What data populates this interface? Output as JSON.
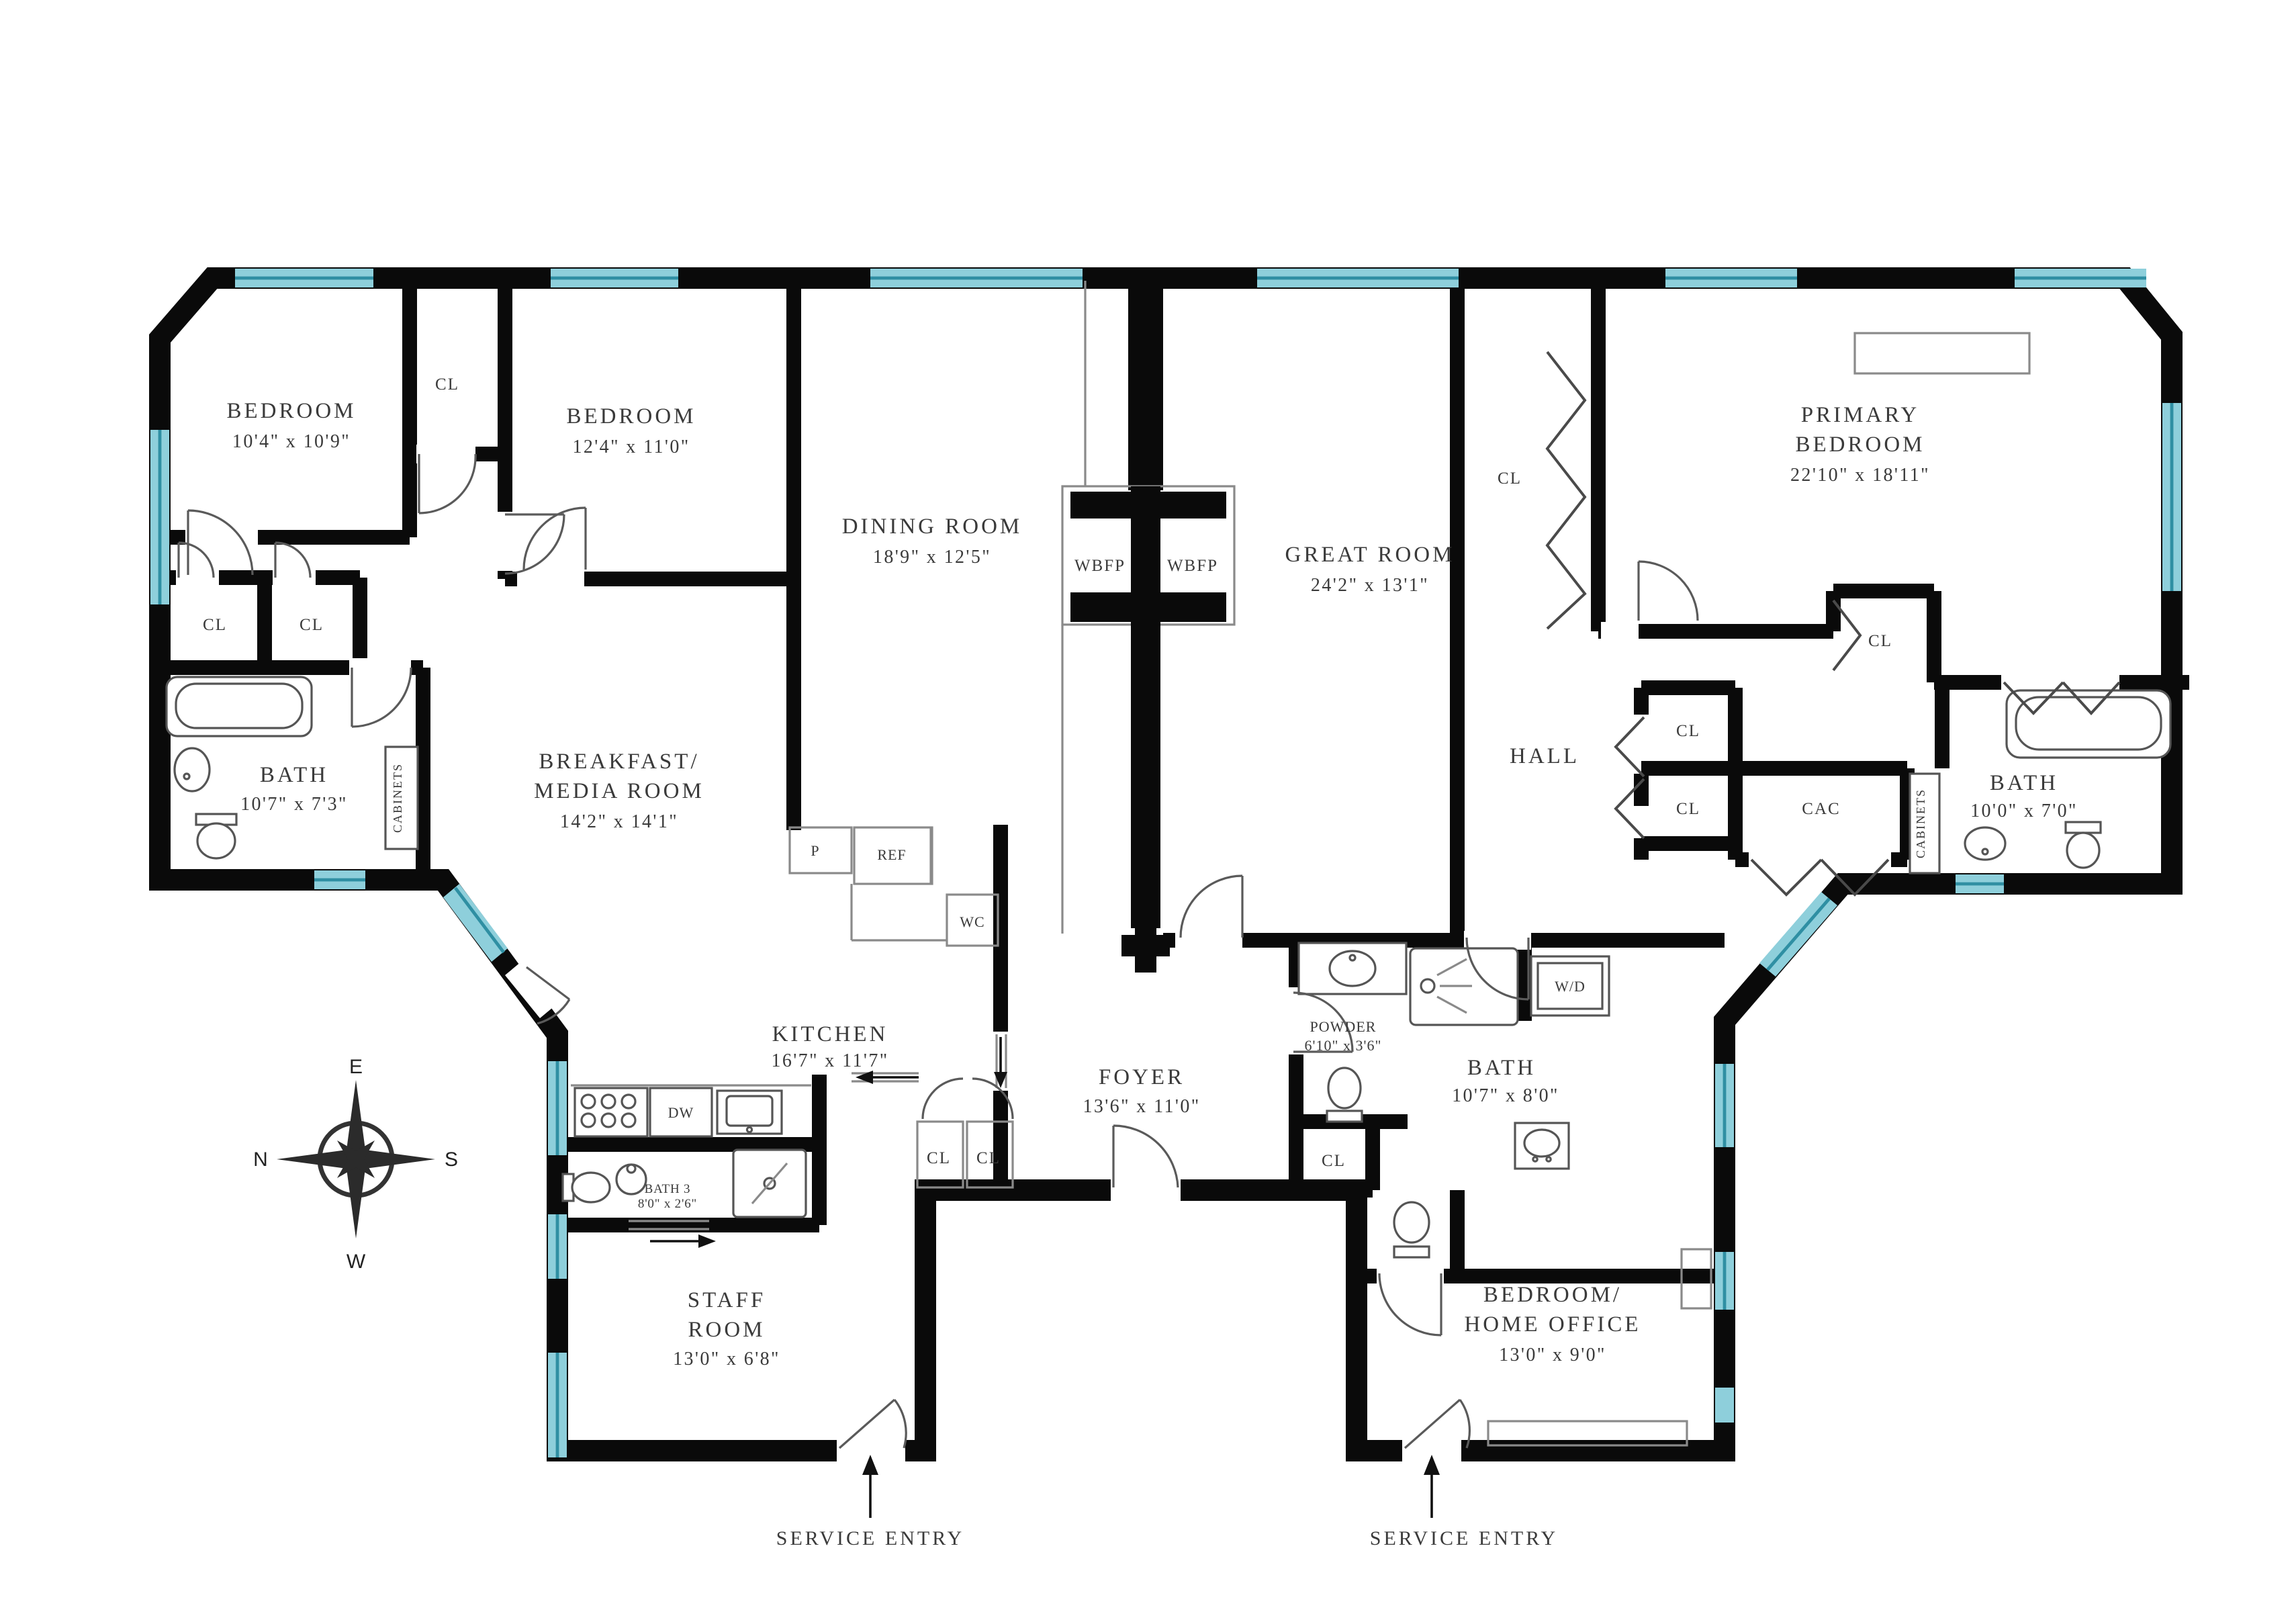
{
  "title": "Apartment Floor Plan",
  "colors": {
    "wall": "#0a0a0a",
    "window": "#8ecfdb",
    "window_stripe": "#2f8fa3",
    "text": "#3a3a3a"
  },
  "rooms": {
    "bedroom1": {
      "name": "BEDROOM",
      "dims": "10'4\" x 10'9\""
    },
    "bedroom2": {
      "name": "BEDROOM",
      "dims": "12'4\" x 11'0\""
    },
    "dining": {
      "name": "DINING ROOM",
      "dims": "18'9\" x 12'5\""
    },
    "great": {
      "name": "GREAT ROOM",
      "dims": "24'2\" x 13'1\""
    },
    "primary": {
      "name1": "PRIMARY",
      "name2": "BEDROOM",
      "dims": "22'10\" x 18'11\""
    },
    "bath_left": {
      "name": "BATH",
      "dims": "10'7\" x 7'3\""
    },
    "breakfast": {
      "name1": "BREAKFAST/",
      "name2": "MEDIA ROOM",
      "dims": "14'2\" x 14'1\""
    },
    "kitchen": {
      "name": "KITCHEN",
      "dims": "16'7\" x 11'7\""
    },
    "bath3": {
      "name": "BATH 3",
      "dims": "8'0\" x 2'6\""
    },
    "staff": {
      "name1": "STAFF",
      "name2": "ROOM",
      "dims": "13'0\" x 6'8\""
    },
    "foyer": {
      "name": "FOYER",
      "dims": "13'6\" x 11'0\""
    },
    "powder": {
      "name": "POWDER",
      "dims": "6'10\" x 3'6\""
    },
    "bath_center": {
      "name": "BATH",
      "dims": "10'7\" x 8'0\""
    },
    "bedroom_office": {
      "name1": "BEDROOM/",
      "name2": "HOME OFFICE",
      "dims": "13'0\" x 9'0\""
    },
    "bath_right": {
      "name": "BATH",
      "dims": "10'0\" x 7'0\""
    },
    "hall": {
      "name": "HALL"
    },
    "cac": {
      "name": "CAC"
    }
  },
  "labels": {
    "closet": "CL",
    "fireplace": "WBFP",
    "cabinets": "CABINETS",
    "pantry": "P",
    "refrigerator": "REF",
    "water_closet": "WC",
    "dishwasher": "DW",
    "washer_dryer": "W/D",
    "service_entry": "SERVICE ENTRY"
  },
  "compass": {
    "north": "N",
    "east": "E",
    "south": "S",
    "west": "W"
  }
}
